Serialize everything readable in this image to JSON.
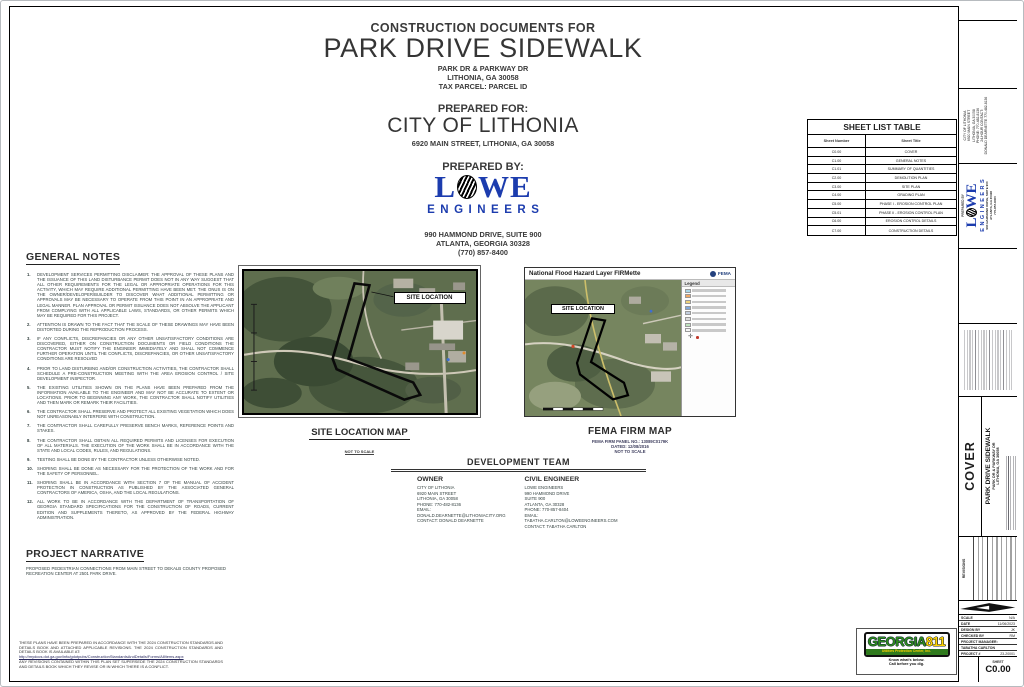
{
  "header": {
    "doc_type": "CONSTRUCTION DOCUMENTS FOR",
    "project_title": "PARK DRIVE SIDEWALK",
    "location_line1": "PARK DR & PARKWAY DR",
    "location_line2": "LITHONIA, GA 30058",
    "location_line3": "TAX PARCEL: PARCEL ID",
    "prepared_for_label": "PREPARED FOR:",
    "client_name": "CITY OF LITHONIA",
    "client_address": "6920 MAIN STREET, LITHONIA, GA 30058",
    "prepared_by_label": "PREPARED BY:",
    "logo": {
      "l": "L",
      "we": "WE",
      "engineers": "ENGINEERS"
    },
    "engineer_address1": "990 HAMMOND DRIVE, SUITE 900",
    "engineer_address2": "ATLANTA, GEORGIA 30328",
    "engineer_phone": "(770) 857-8400"
  },
  "sheet_list": {
    "title": "SHEET LIST TABLE",
    "col_number": "Sheet Number",
    "col_title": "Sheet Title",
    "rows": [
      [
        "C0.00",
        "COVER"
      ],
      [
        "C1.00",
        "GENERAL NOTES"
      ],
      [
        "C1.01",
        "SUMMARY OF QUANTITIES"
      ],
      [
        "C2.00",
        "DEMOLITION PLAN"
      ],
      [
        "C3.00",
        "SITE PLAN"
      ],
      [
        "C4.00",
        "GRADING PLAN"
      ],
      [
        "C5.00",
        "PHASE I - EROSION CONTROL PLAN"
      ],
      [
        "C5.01",
        "PHASE II - EROSION CONTROL PLAN"
      ],
      [
        "C6.00",
        "EROSION CONTROL DETAILS"
      ],
      [
        "C7.00",
        "CONSTRUCTION DETAILS"
      ]
    ]
  },
  "general_notes": {
    "title": "GENERAL NOTES",
    "notes": [
      "DEVELOPMENT SERVICES PERMITTING DISCLAIMER: THE APPROVAL OF THESE PLANS AND THE ISSUANCE OF THIS LAND DISTURBANCE PERMIT DOES NOT IN ANY WAY SUGGEST THAT ALL OTHER REQUIREMENTS FOR THE LEGAL OR APPROPRIATE OPERATIONS FOR THIS ACTIVITY, WHICH MAY REQUIRE ADDITIONAL PERMITTING HAVE BEEN MET. THE ONUS IS ON THE OWNER/DEVELOPER/BUILDER TO DISCOVER WHAT ADDITIONAL PERMITTING OR APPROVALS MAY BE NECESSARY TO OPERATE FROM THIS POINT IN AN APPROPRIATE AND LEGAL MANNER. PLAN APPROVAL OR PERMIT ISSUANCE DOES NOT ABSOLVE THE APPLICANT FROM COMPLYING WITH ALL APPLICABLE LAWS, STANDARDS, OR OTHER PERMITS WHICH MAY BE REQUIRED FOR THIS PROJECT.",
      "ATTENTION IS DRAWN TO THE FACT THAT THE SCALE OF THESE DRAWINGS MAY HAVE BEEN DISTORTED DURING THE REPRODUCTION PROCESS.",
      "IF ANY CONFLICTS, DISCREPANCIES OR ANY OTHER UNSATISFACTORY CONDITIONS ARE DISCOVERED, EITHER ON CONSTRUCTION DOCUMENTS OR FIELD CONDITIONS THE CONTRACTOR MUST NOTIFY THE ENGINEER IMMEDIATELY AND SHALL NOT COMMENCE FURTHER OPERATION UNTIL THE CONFLICTS, DISCREPANCIES, OR OTHER UNSATISFACTORY CONDITIONS ARE RESOLVED",
      "PRIOR TO LAND DISTURBING AND/OR CONSTRUCTION ACTIVITIES, THE CONTRACTOR SHALL SCHEDULE A PRE-CONSTRUCTION MEETING WITH THE AREA EROSION CONTROL / SITE DEVELOPMENT INSPECTOR.",
      "THE EXISTING UTILITIES SHOWN ON THE PLANS HAVE BEEN PREPARED FROM THE INFORMATION AVAILABLE TO THE ENGINEER AND MAY NOT BE ACCURATE TO EXTENT OR LOCATIONS. PRIOR TO BEGINNING ANY WORK, THE CONTRACTOR SHALL NOTIFY UTILITIES AND THEN MARK OR REMARK THEIR FACILITIES.",
      "THE CONTRACTOR SHALL PRESERVE AND PROTECT ALL EXISTING VEGETATION WHICH DOES NOT UNREASONABLY INTERFERE WITH CONSTRUCTION.",
      "THE CONTRACTOR SHALL CAREFULLY PRESERVE BENCH MARKS, REFERENCE POINTS AND STAKES.",
      "THE CONTRACTOR SHALL OBTAIN ALL REQUIRED PERMITS AND LICENSES FOR EXECUTION OF ALL MATERIALS. THE EXECUTION OF THE WORK SHALL BE IN ACCORDANCE WITH THE STATE AND LOCAL CODES, RULES, AND REGULATIONS.",
      "TESTING SHALL BE DONE BY THE CONTRACTOR UNLESS OTHERWISE NOTED.",
      "SHORING SHALL BE DONE AS NECESSARY FOR THE PROTECTION OF THE WORK AND FOR THE SAFETY OF PERSONNEL.",
      "SHORING SHALL BE IN ACCORDANCE WITH SECTION 7 OF THE MANUAL OF ACCIDENT PROTECTION IN CONSTRUCTION AS PUBLISHED BY THE ASSOCIATED GENERAL CONTRACTORS OF AMERICA, OSHA, AND THE LOCAL REGULATIONS.",
      "ALL WORK TO BE IN ACCORDANCE WITH THE DEPARTMENT OF TRANSPORTATION OF GEORGIA STANDARD SPECIFICATIONS FOR THE CONSTRUCTION OF ROADS, CURRENT EDITION AND SUPPLEMENTS THERETO, AS APPROVED BY THE FEDERAL HIGHWAY ADMINISTRATION."
    ]
  },
  "site_map": {
    "label": "SITE LOCATION",
    "caption": "SITE LOCATION MAP",
    "scale_note": "NOT TO SCALE"
  },
  "fema_map": {
    "header": "National Flood Hazard Layer FIRMette",
    "agency": "FEMA",
    "legend_title": "Legend",
    "label": "SITE LOCATION",
    "caption": "FEMA FIRM MAP",
    "panel_line": "FEMA FIRM PANEL NO.: 13089C0179K",
    "dated_line": "DATED: 12/08/2016",
    "scale_note": "NOT TO SCALE",
    "legend_colors": [
      "#a9d7e8",
      "#f2a966",
      "#eed27a",
      "#7fa8d9",
      "#c3cfe0",
      "#dcdcdc",
      "#bfe3bf",
      "#f5f5f5"
    ]
  },
  "development_team": {
    "title": "DEVELOPMENT TEAM",
    "owner_label": "OWNER",
    "owner_lines": [
      "CITY OF LITHONIA",
      "6920 MAIN STREET",
      "LITHONIA, GA 30058",
      "PHONE: 770-482-8136",
      "EMAIL:",
      "DONALD.DEARNETTE@LITHONIACITY.ORG",
      "CONTACT: DONALD DEARNETTE"
    ],
    "engineer_label": "CIVIL ENGINEER",
    "engineer_lines": [
      "LOWE ENGINEERS",
      "990 HAMMOND DRIVE",
      "SUITE 900",
      "ATLANTA, GA 30328",
      "PHONE: 770-857-8404",
      "EMAIL:",
      "TABATHA.CARLTON@LOWEENGINEERS.COM",
      "CONTACT: TABATHA CARLTON"
    ]
  },
  "project_narrative": {
    "title": "PROJECT NARRATIVE",
    "text": "PROPOSED PEDESTRIAN CONNECTIONS FROM MAIN STREET TO DEKALB COUNTY PROPOSED RECREATION CENTER AT 2501 PARK DRIVE."
  },
  "standards_note": {
    "text1": "THESE PLANS HAVE BEEN PREPARED IN ACCORDANCE WITH THE 2024 CONSTRUCTION STANDARDS AND DETAILS BOOK AND ATTACHED APPLICABLE REVISIONS. THE 2024 CONSTRUCTION STANDARDS AND DETAILS BOOK IS AVAILABLE AT:",
    "link": "http://mydocs.dot.ga.gov/info/gdotpubs/ConstructionStandardsAndDetails/Forms/AllItems.aspx",
    "text2": "ANY REVISIONS CONTAINED WITHIN THIS PLAN SET SUPERSEDE THE 2024 CONSTRUCTION STANDARDS AND DETAILS BOOK WHICH THEY REVISE OR IN WHICH THERE IS A CONFLICT."
  },
  "georgia811": {
    "word": "GEORGIA",
    "number": "811",
    "bar_text": "Utilities Protection Center, Inc.",
    "tag1": "Know what's below.",
    "tag2": "Call before you dig."
  },
  "titleblock": {
    "client_lines": [
      "CITY OF LITHONIA",
      "6920 MAIN STREET",
      "LITHONIA, GA 30058",
      "PHONE: 770-482-8136",
      "",
      "24-HOUR CONTACT:",
      "DONALD DEARNETTE 770-482-8136"
    ],
    "prepared_by_label": "PREPARED BY",
    "lowe_l": "L",
    "lowe_we": "WE",
    "lowe_engineers": "ENGINEERS",
    "lowe_addr1": "990 HAMMOND DRIVE, SUITE 900",
    "lowe_addr2": "ATLANTA, GA 30328",
    "lowe_addr3": "770-857-8400",
    "sheet_name": "COVER",
    "project_name": "PARK DRIVE SIDEWALK",
    "project_addr1": "PARK DR & PARKWAY DR",
    "project_addr2": "LITHONIA, GA 30058",
    "revisions_label": "REVISIONS",
    "fields": [
      [
        "SCALE",
        "N/A"
      ],
      [
        "DATE",
        "11/06/2023"
      ],
      [
        "DESIGN BY",
        "JK"
      ],
      [
        "CHECKED BY",
        "RM"
      ],
      [
        "PROJECT MANAGER:",
        ""
      ],
      [
        "TABATHA CARLTON",
        ""
      ],
      [
        "PROJECT #",
        "23-20001"
      ]
    ],
    "sheet_label": "SHEET",
    "sheet_number": "C0.00"
  }
}
